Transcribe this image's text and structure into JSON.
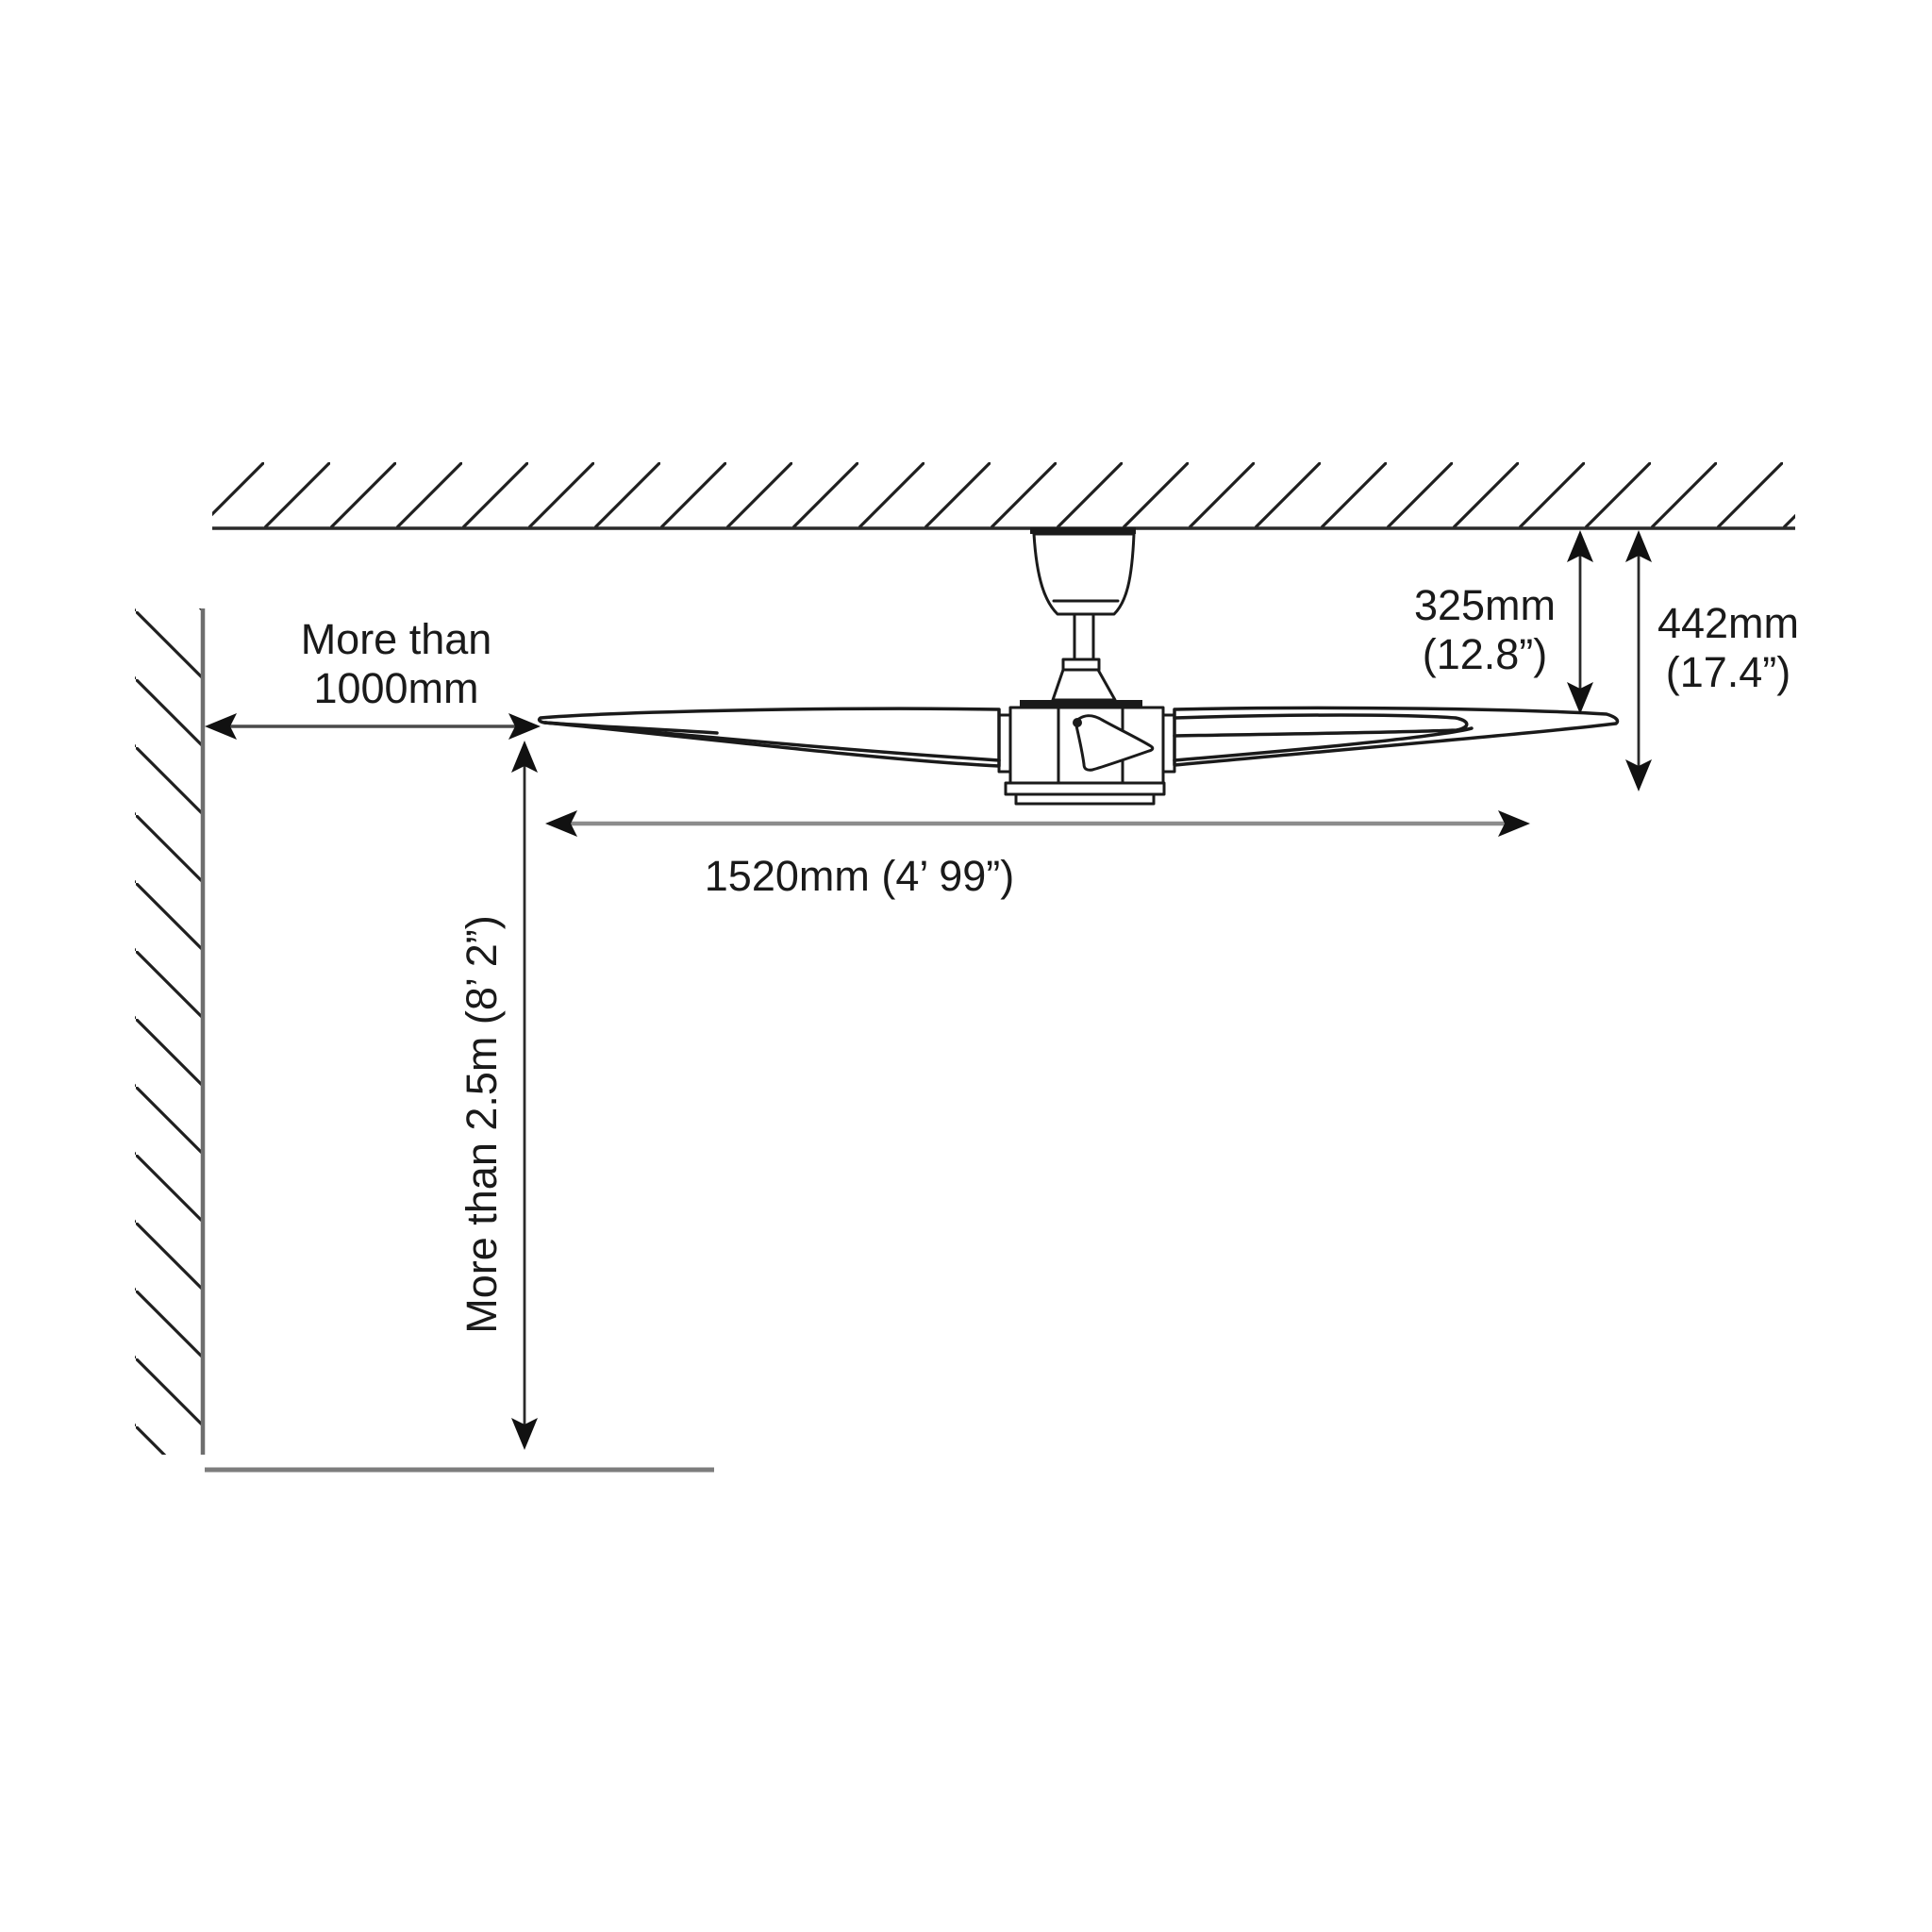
{
  "diagram": {
    "title": "ceiling-fan-installation-clearance-diagram",
    "labels": {
      "wall_clearance": "More than\n1000mm",
      "floor_clearance": "More than 2.5m (8’ 2”)",
      "ceiling_to_blade": "325mm\n(12.8”)",
      "total_drop": "442mm\n(17.4”)",
      "blade_span": "1520mm (4’ 99”)"
    },
    "colors": {
      "background": "#ffffff",
      "ink": "#1a1a1a",
      "ceiling_line": "#2a2a2a",
      "wall_line": "#6e6e6e",
      "floor_line": "#7d7d7d",
      "dim_line_gray": "#8c8c8c",
      "dim_line_dark": "#3a3a3a"
    }
  }
}
